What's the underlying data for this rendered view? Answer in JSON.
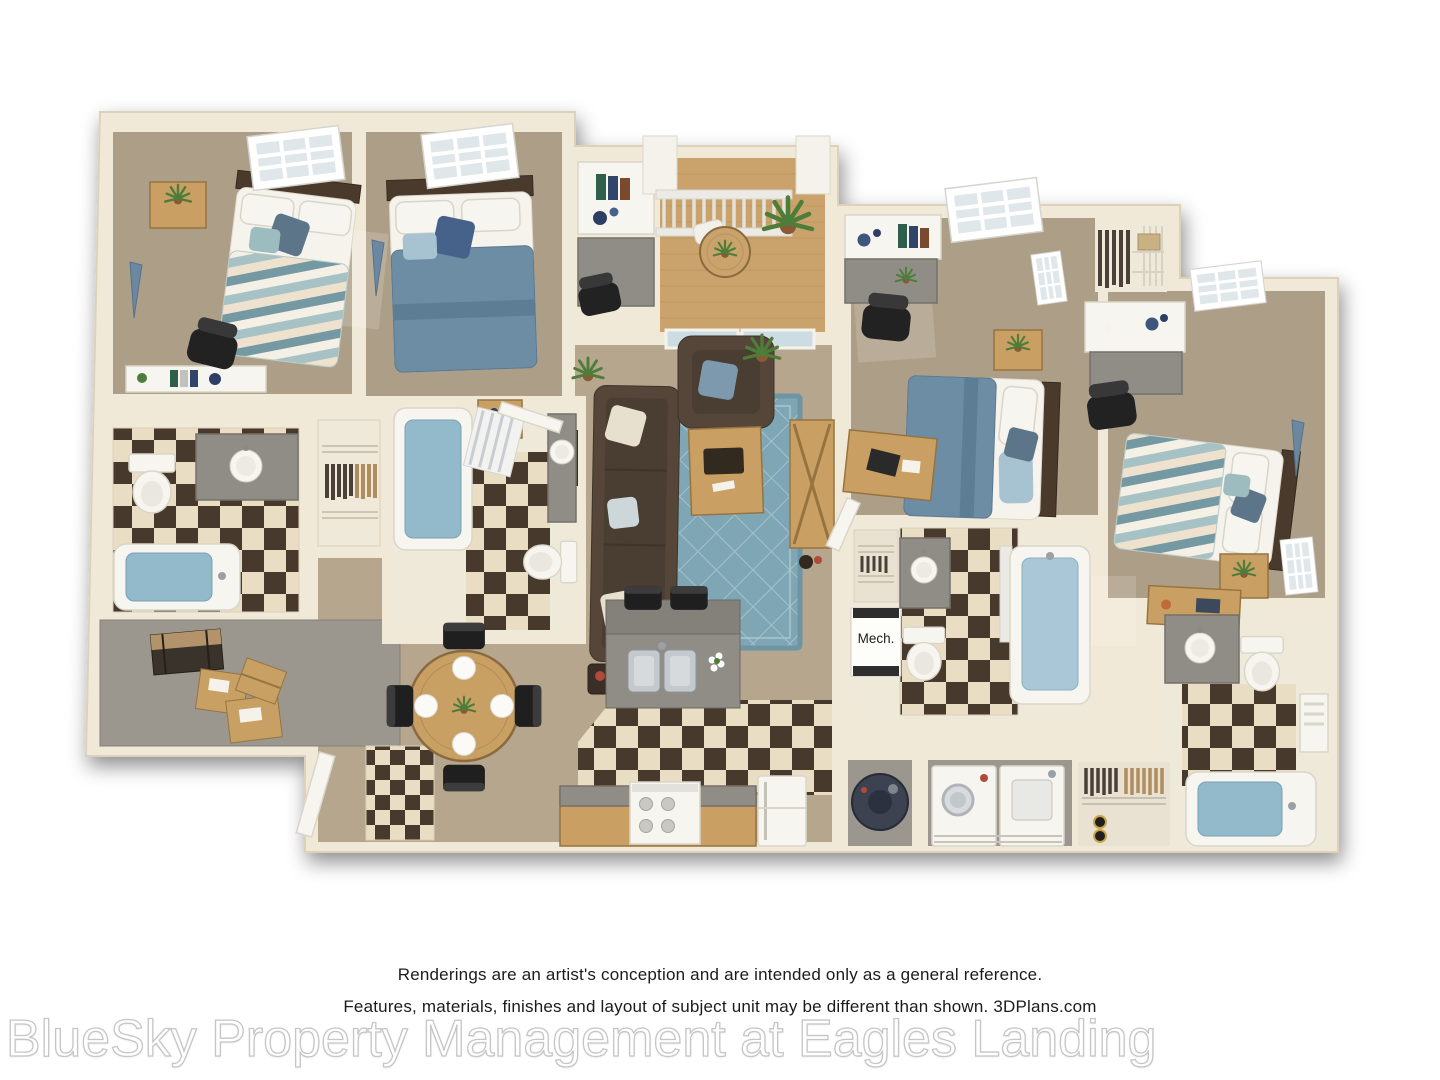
{
  "page": {
    "width": 1440,
    "height": 1080,
    "background": "#ffffff"
  },
  "floor_plan": {
    "type": "3d-apartment-floor-plan-rendering",
    "view": "top-down dollhouse render",
    "unit_summary": "4 bedroom / 4 bathroom apartment with living room, kitchen, dining area, balcony, laundry room, mechanical closet and storage room",
    "mech_label": "Mech.",
    "rooms": [
      "bedroom-1",
      "bedroom-2",
      "bedroom-3",
      "bedroom-4",
      "living-room",
      "kitchen",
      "dining-area",
      "balcony",
      "bathroom-1",
      "bathroom-2",
      "bathroom-3",
      "bathroom-4",
      "laundry-room",
      "mechanical-closet",
      "storage-room",
      "closets"
    ],
    "palette": {
      "wall_cream": "#f1e9d8",
      "wall_edge": "#dcd2bc",
      "carpet_tan": "#ad9e87",
      "carpet_light": "#b5a68d",
      "storage_gray": "#9b978f",
      "checker_dark": "#473a2d",
      "checker_cream": "#e9dec3",
      "rug_blue": "#7ea6b4",
      "duvet_blue": "#6d8da5",
      "duvet_chevron_teal": "#7499a3",
      "sofa_brown": "#564639",
      "wood": "#c99f63",
      "granite_gray": "#8f8d85",
      "water_blue": "#93bacb",
      "pennant_blue": "#6c88a0",
      "watermark_outline": "#c6c6c6",
      "text_color": "#1b1b1b"
    }
  },
  "footer": {
    "disclaimer_line1": "Renderings are an artist's conception and are intended only as a general reference.",
    "disclaimer_line2": "Features, materials, finishes and layout of subject unit may be different than shown. 3DPlans.com",
    "watermark": "BlueSky Property Management at Eagles Landing"
  }
}
